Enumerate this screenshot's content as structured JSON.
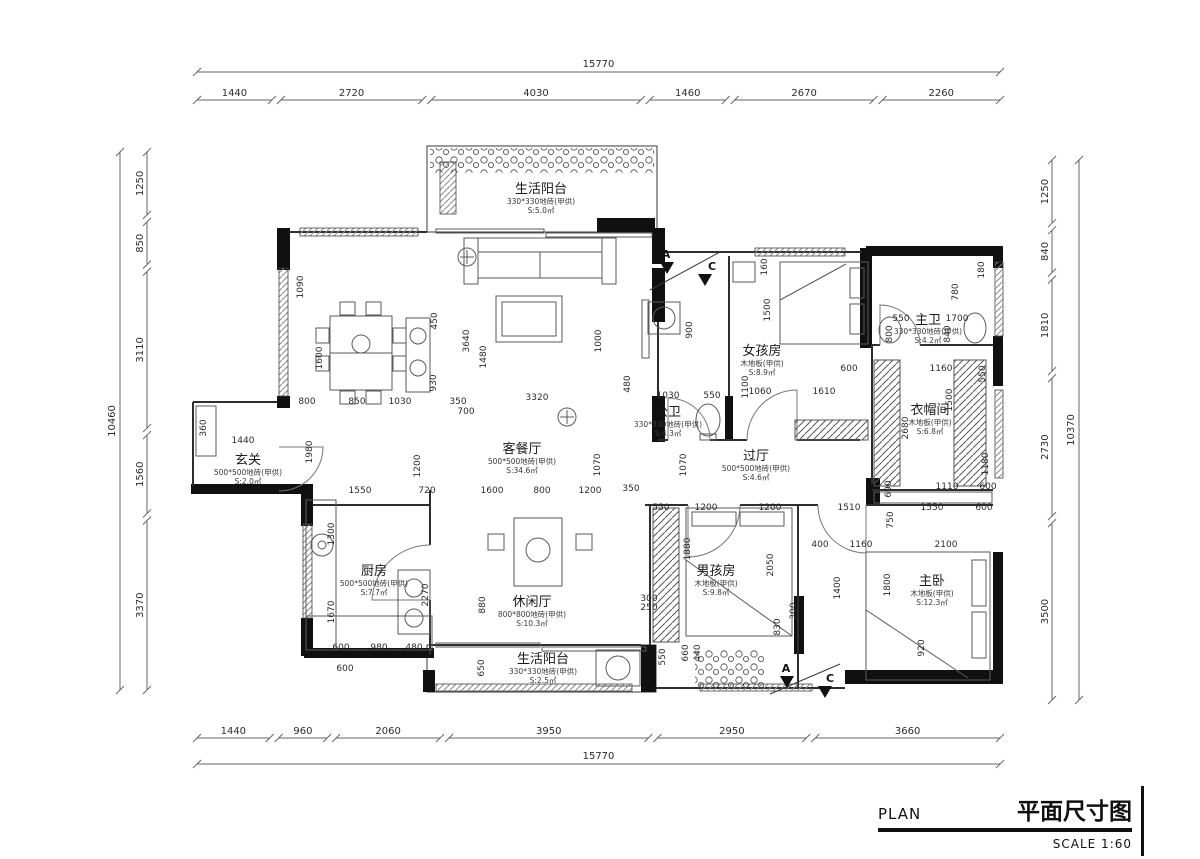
{
  "title_block": {
    "plan_en": "PLAN",
    "plan_cn": "平面尺寸图",
    "scale": "SCALE 1:60"
  },
  "rooms": [
    {
      "name": "生活阳台",
      "material": "330*330地砖(甲供)",
      "area": "S:5.0㎡"
    },
    {
      "name": "玄关",
      "material": "500*500地砖(甲供)",
      "area": "S:2.0㎡"
    },
    {
      "name": "客餐厅",
      "material": "500*500地砖(甲供)",
      "area": "S:34.6㎡"
    },
    {
      "name": "公卫",
      "material": "330*330地砖(甲供)",
      "area": "S:4.3㎡"
    },
    {
      "name": "女孩房",
      "material": "木地板(甲供)",
      "area": "S:8.9㎡"
    },
    {
      "name": "主卫",
      "material": "330*330地砖(甲供)",
      "area": "S:4.2㎡"
    },
    {
      "name": "衣帽间",
      "material": "木地板(甲供)",
      "area": "S:6.8㎡"
    },
    {
      "name": "过厅",
      "material": "500*500地砖(甲供)",
      "area": "S:4.6㎡"
    },
    {
      "name": "厨房",
      "material": "500*500地砖(甲供)",
      "area": "S:7.7㎡"
    },
    {
      "name": "休闲厅",
      "material": "800*800地砖(甲供)",
      "area": "S:10.3㎡"
    },
    {
      "name": "男孩房",
      "material": "木地板(甲供)",
      "area": "S:9.8㎡"
    },
    {
      "name": "主卧",
      "material": "木地板(甲供)",
      "area": "S:12.3㎡"
    },
    {
      "name": "生活阳台",
      "material": "330*330地砖(甲供)",
      "area": "S:2.5㎡"
    }
  ],
  "dim_chains": {
    "top": [
      "1440",
      "2720",
      "4030",
      "1460",
      "2670",
      "2260"
    ],
    "top_total": "15770",
    "bottom": [
      "1440",
      "960",
      "2060",
      "3950",
      "2950",
      "3660"
    ],
    "bottom_total": "15770",
    "left": [
      "1250",
      "850",
      "3110",
      "1560",
      "3370"
    ],
    "left_total": "10460",
    "right": [
      "1250",
      "840",
      "1810",
      "2730",
      "3500"
    ],
    "right_total": "10370"
  },
  "interior_dims": [
    "1090",
    "1600",
    "800",
    "850",
    "1030",
    "930",
    "350",
    "450",
    "3640",
    "1480",
    "700",
    "3320",
    "1200",
    "1000",
    "480",
    "900",
    "1030",
    "550",
    "1060",
    "1610",
    "1100",
    "1500",
    "600",
    "550",
    "1700",
    "800",
    "840",
    "1160",
    "550",
    "2680",
    "1500",
    "1180",
    "1110",
    "690",
    "600",
    "1980",
    "1550",
    "720",
    "1600",
    "800",
    "1200",
    "350",
    "1070",
    "1070",
    "550",
    "1200",
    "1200",
    "1510",
    "750",
    "1550",
    "600",
    "400",
    "1160",
    "2100",
    "1880",
    "2050",
    "1400",
    "1800",
    "1300",
    "1670",
    "2270",
    "880",
    "600",
    "980",
    "480",
    "600",
    "650",
    "300",
    "250",
    "830",
    "300",
    "550",
    "660",
    "440",
    "920",
    "360",
    "1440",
    "160",
    "780",
    "180"
  ],
  "section_markers": [
    "A",
    "C",
    "A",
    "C"
  ],
  "colors": {
    "wall": "#101010",
    "line": "#555555",
    "dim_text": "#2b2b2b",
    "bg": "#ffffff"
  }
}
